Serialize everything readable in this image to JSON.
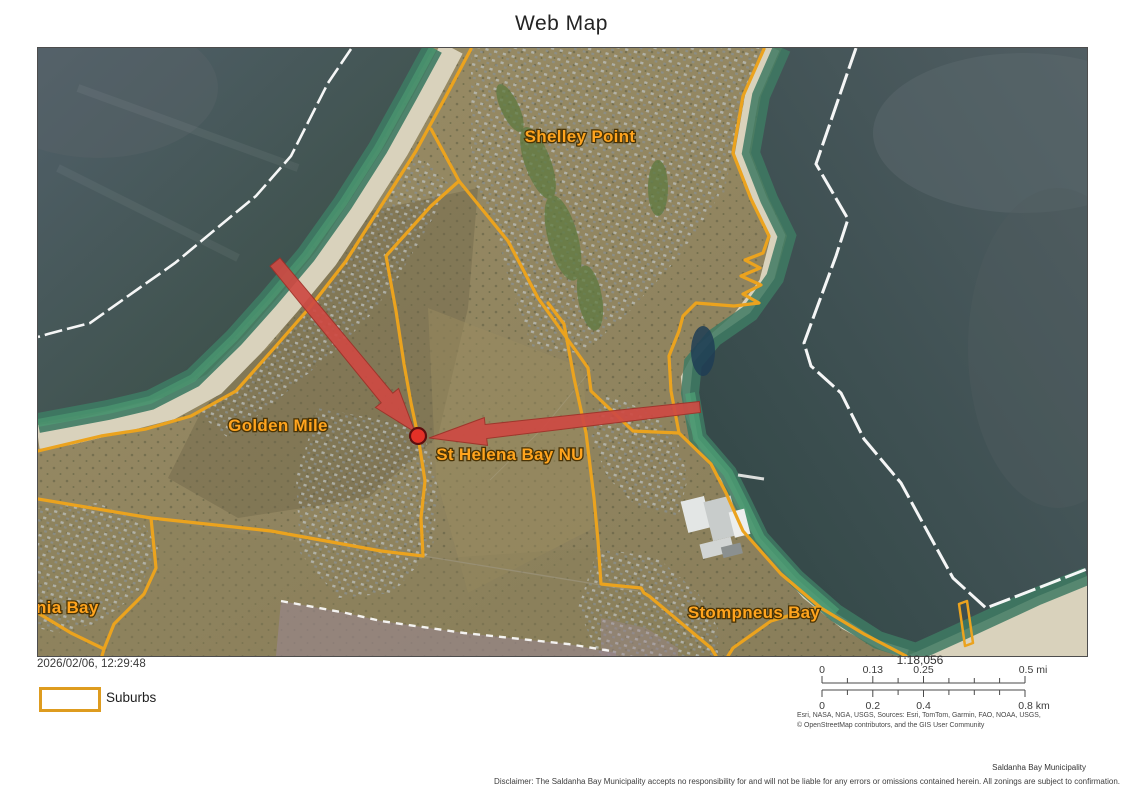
{
  "title": "Web Map",
  "map": {
    "labels": [
      {
        "id": "shelley-point",
        "text": "Shelley Point"
      },
      {
        "id": "golden-mile",
        "text": "Golden Mile"
      },
      {
        "id": "st-helena-bay-nu",
        "text": "St Helena Bay NU"
      },
      {
        "id": "stompneus-bay",
        "text": "Stompneus Bay"
      },
      {
        "id": "britannia-bay-clipped",
        "text": "nia Bay"
      }
    ]
  },
  "legend": {
    "datetime": "2026/02/06, 12:29:48",
    "items": [
      {
        "label": "Suburbs",
        "outline_color": "#DE9C1F"
      }
    ]
  },
  "scale": {
    "ratio": "1:18,056",
    "mi": {
      "ticks": [
        "0",
        "0.13",
        "0.25"
      ],
      "end": "0.5 mi"
    },
    "km": {
      "ticks": [
        "0",
        "0.2",
        "0.4"
      ],
      "end": "0.8 km"
    }
  },
  "attribution": {
    "line1": "Esri, NASA, NGA, USGS, Sources: Esri, TomTom, Garmin, FAO, NOAA, USGS,",
    "line2": "© OpenStreetMap contributors, and the GIS User Community"
  },
  "footer": {
    "organization": "Saldanha Bay Municipality",
    "disclaimer": "Disclaimer: The Saldanha Bay Municipality accepts no responsibility for and will not be liable for any errors or omissions contained herein.  All zonings are subject to confirmation."
  },
  "colors": {
    "suburb_outline": "#EBA31E",
    "map_label": "#FFA41E",
    "arrow": "#CE4A43",
    "marker": "#E33127"
  }
}
